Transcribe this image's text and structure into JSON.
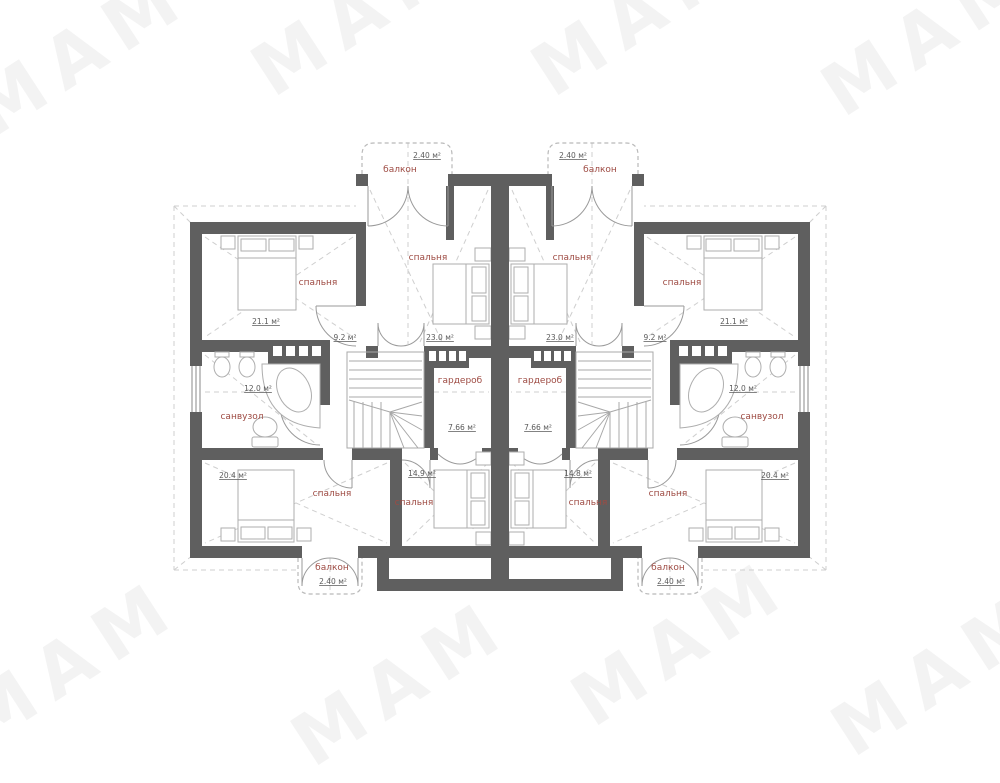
{
  "watermark": {
    "text": "МАМ"
  },
  "plan": {
    "left_unit": {
      "balcony_top": {
        "label": "балкон",
        "area": "2.40 м²"
      },
      "bedroom_side_top": {
        "label": "спальня",
        "area": "21.1 м²"
      },
      "bedroom_center_top": {
        "label": "спальня",
        "area": "23.0 м²"
      },
      "hall": {
        "area": "9.2 м²"
      },
      "bathroom": {
        "label": "санвузол",
        "area": "12.0 м²"
      },
      "wardrobe": {
        "label": "гардероб",
        "area": "7.66 м²"
      },
      "bedroom_side_bottom": {
        "label": "спальня",
        "area": "20.4 м²"
      },
      "bedroom_center_bottom": {
        "label": "спальня",
        "area": "14.9 м²"
      },
      "balcony_bottom": {
        "label": "балкон",
        "area": "2.40 м²"
      }
    },
    "right_unit": {
      "balcony_top": {
        "label": "балкон",
        "area": "2.40 м²"
      },
      "bedroom_side_top": {
        "label": "спальня",
        "area": "21.1 м²"
      },
      "bedroom_center_top": {
        "label": "спальня",
        "area": "23.0 м²"
      },
      "hall": {
        "area": "9.2 м²"
      },
      "bathroom": {
        "label": "санвузол",
        "area": "12.0 м²"
      },
      "wardrobe": {
        "label": "гардероб",
        "area": "7.66 м²"
      },
      "bedroom_side_bottom": {
        "label": "спальня",
        "area": "20.4 м²"
      },
      "bedroom_center_bottom": {
        "label": "спальня",
        "area": "14.8 м²"
      },
      "balcony_bottom": {
        "label": "балкон",
        "area": "2.40 м²"
      }
    }
  },
  "colors": {
    "wall": "#5f5f5f",
    "room_label": "#9e4b43",
    "area_text": "#5a5a5a"
  }
}
